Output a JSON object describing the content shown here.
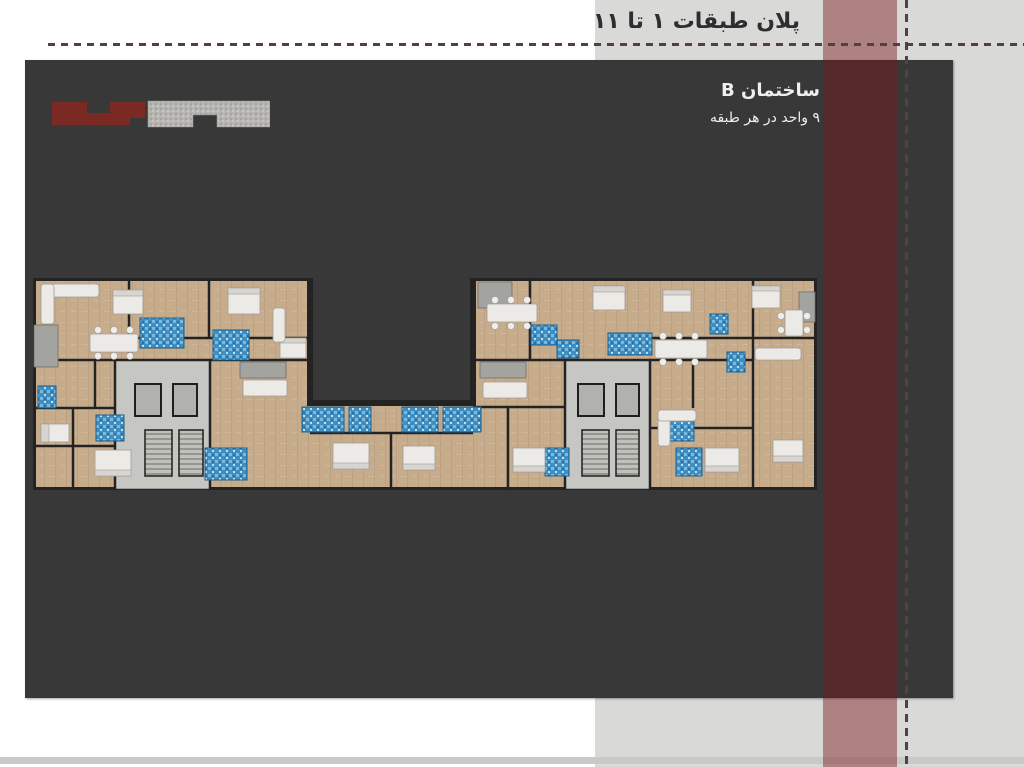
{
  "header": {
    "title": "پلان طبقات ١ تا ١١"
  },
  "slide": {
    "building_label": "ساختمان B",
    "units_label": "٩ واحد در هر طبقه"
  },
  "colors": {
    "page_bg": "#ffffff",
    "panel": "#d9d9d7",
    "bottom_strip": "#c9c9c7",
    "slide_bg": "#383838",
    "header_text": "#2e2e2e",
    "slide_text": "#efefed",
    "accent_stripe": "rgba(122,24,28,0.45)",
    "dash": "#54403f",
    "thumb_red": "#7a2a22",
    "thumb_gray": "#b6b5b1",
    "plan_floor": "#c7ac8c",
    "plan_wall": "#232323",
    "plan_core": "#c6c6c3",
    "plan_bath": "#3f8ec1",
    "plan_furniture": "#eceae6",
    "plan_kitchen": "#a3a39f"
  }
}
